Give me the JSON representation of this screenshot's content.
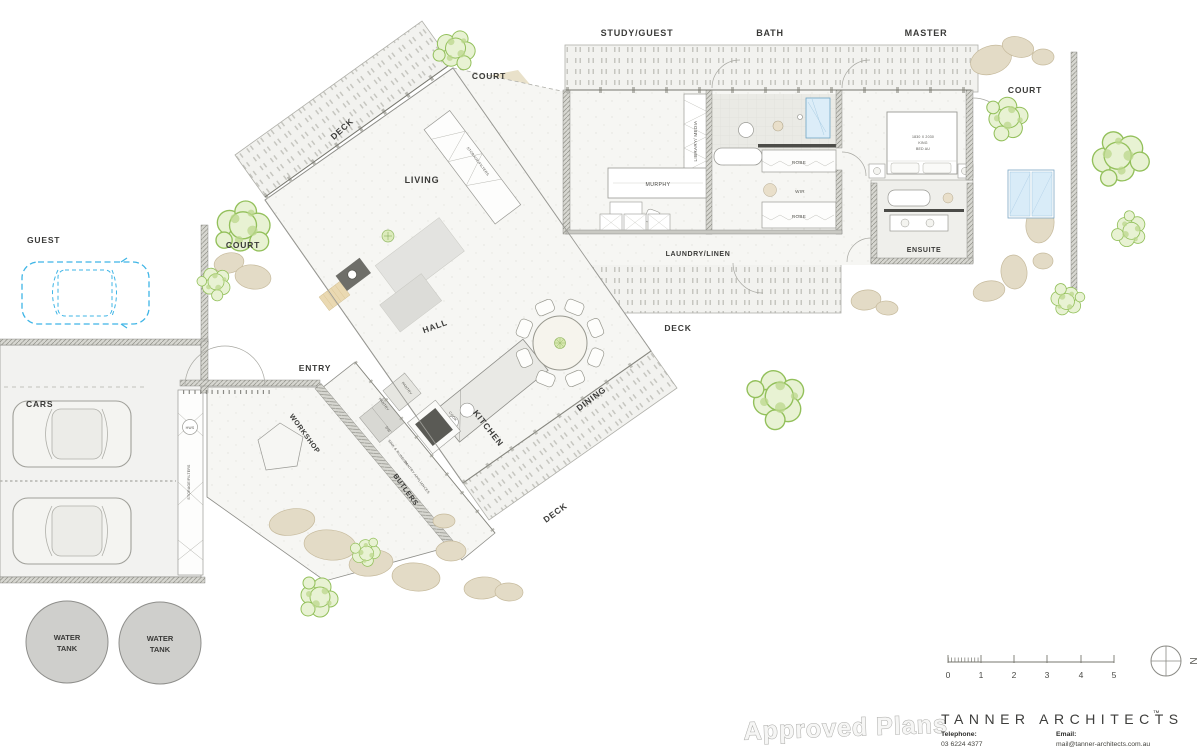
{
  "plan_labels": {
    "study_guest": "STUDY/GUEST",
    "bath": "BATH",
    "master": "MASTER",
    "court": "COURT",
    "deck": "DECK",
    "living": "LIVING",
    "hall": "HALL",
    "entry": "ENTRY",
    "dining": "DINING",
    "kitchen": "KITCHEN",
    "workshop": "WORKSHOP",
    "butlers": "BUTLERS",
    "laundry_linen": "LAUNDRY/LINEN",
    "ensuite": "ENSUITE",
    "guest_parking": "GUEST",
    "cars": "CARS",
    "water_tank_line1": "WATER",
    "water_tank_line2": "TANK"
  },
  "fixture_labels": {
    "library_media": "LIBRARY/ MEDIA",
    "murphy": "MURPHY",
    "robe": "ROBE",
    "wir": "WIR",
    "bed_line1": "1830 X 2030",
    "bed_line2": "KING",
    "bed_line3": "BED AU",
    "hws": "HWS",
    "storage_filters": "STORAGE/FILTERS",
    "pantry": "PANTRY",
    "cook": "COOK",
    "dw": "DW",
    "sink_rubbish": "SINK & RUBBISH",
    "pantry_appliances": "PANTRY APPLIANCES"
  },
  "scale_bar": {
    "tick_0": "0",
    "tick_1": "1",
    "tick_2": "2",
    "tick_3": "3",
    "tick_4": "4",
    "tick_5": "5"
  },
  "north_arrow": {
    "label": "N"
  },
  "title_block": {
    "watermark": "Approved Plans",
    "brand": "TANNER ARCHITECTS",
    "trademark": "™",
    "telephone_label": "Telephone:",
    "telephone_number": "03 6224 4377",
    "email_label": "Email:",
    "email_address": "mail@tanner-architects.com.au"
  },
  "colors": {
    "accent_blue": "#3fb5e6",
    "tree_green": "#93c05b",
    "rock_tan": "#e3dbc6",
    "wall_gray": "#d7d7d1",
    "tank_gray": "#cfcfcc"
  }
}
